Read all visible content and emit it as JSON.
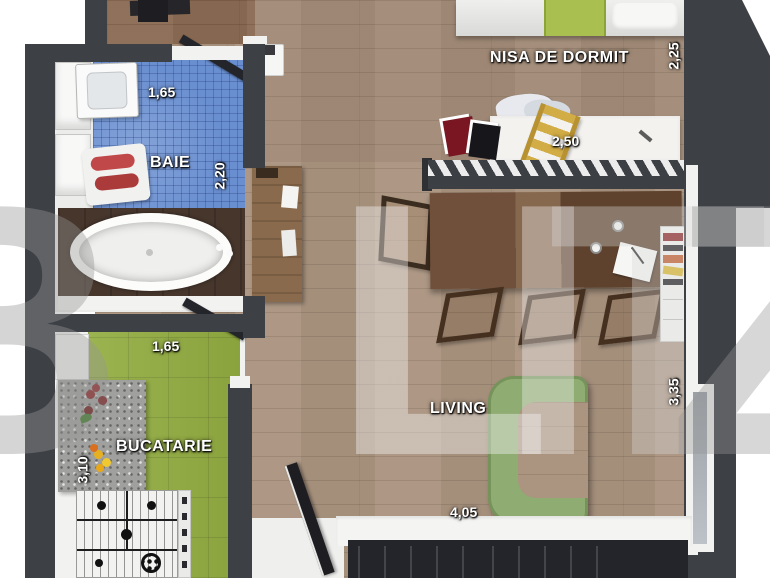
{
  "watermark": {
    "text": "BLITZ",
    "chars": {
      "c0": "B",
      "c1": "L",
      "c2": "I",
      "c3": "T",
      "c4": "Z"
    }
  },
  "rooms": {
    "nisa_de_dormit": {
      "label": "NISA DE DORMIT",
      "dims": {
        "depth": "2,25",
        "width": "2,50"
      }
    },
    "baie": {
      "label": "BAIE",
      "dims": {
        "width": "1,65",
        "depth": "2,20"
      }
    },
    "bucatarie": {
      "label": "BUCATARIE",
      "dims": {
        "door": "1,65",
        "depth": "3,10"
      }
    },
    "living": {
      "label": "LIVING",
      "dims": {
        "width": "4,05",
        "depth": "3,35"
      }
    }
  },
  "palette": {
    "wall": "#3d4045",
    "wood_floor": "#a8917c",
    "bath_tile": "#6a8fd0",
    "kitchen_tile": "#93ad41",
    "sofa_green": "#8fac72",
    "bed_blanket_green": "#a9c050",
    "tub_platform": "#46362c"
  }
}
